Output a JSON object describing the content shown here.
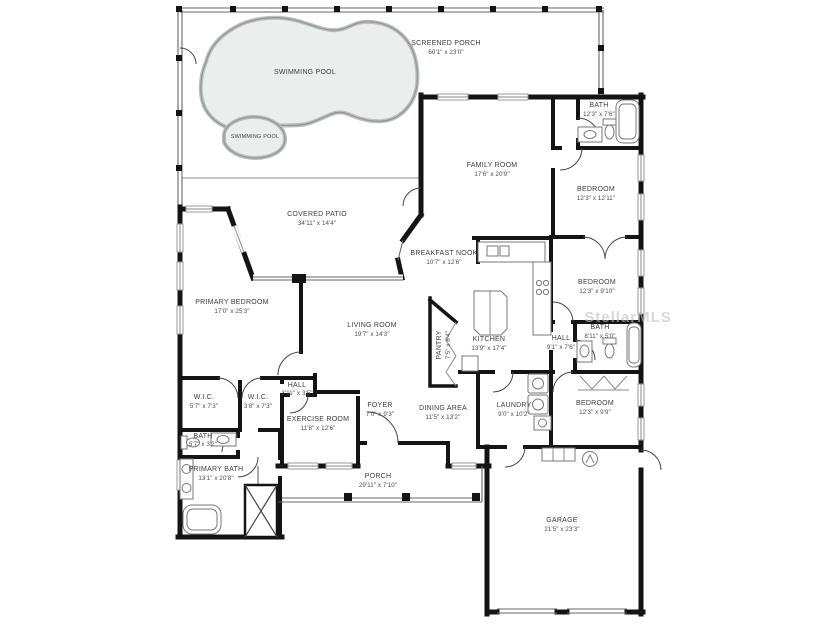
{
  "watermark": "StellarMLS",
  "colors": {
    "wall": "#141414",
    "label_text": "#3c3c3c",
    "pool_fill": "#eceeee",
    "pool_stroke": "#8f9696",
    "watermark": "#bcbfbf"
  },
  "rooms": [
    {
      "name": "SWIMMING POOL",
      "dims": ""
    },
    {
      "name": "SWIMMING POOL",
      "dims": ""
    },
    {
      "name": "SCREENED PORCH",
      "dims": "60'1\" x 23'0\""
    },
    {
      "name": "FAMILY ROOM",
      "dims": "17'6\" x 20'9\""
    },
    {
      "name": "BATH",
      "dims": "12'3\" x 7'6\""
    },
    {
      "name": "BEDROOM",
      "dims": "12'3\" x 12'11\""
    },
    {
      "name": "COVERED PATIO",
      "dims": "34'11\" x 14'4\""
    },
    {
      "name": "BREAKFAST NOOK",
      "dims": "10'7\" x 12'6\""
    },
    {
      "name": "BEDROOM",
      "dims": "12'3\" x 9'10\""
    },
    {
      "name": "KITCHEN",
      "dims": "13'9\" x 17'4\""
    },
    {
      "name": "PANTRY",
      "dims": "7'5\" x 8'4\""
    },
    {
      "name": "PRIMARY BEDROOM",
      "dims": "17'0\" x 25'3\""
    },
    {
      "name": "LIVING ROOM",
      "dims": "19'7\" x 14'3\""
    },
    {
      "name": "BATH",
      "dims": "8'11\" x 5'0\""
    },
    {
      "name": "HALL",
      "dims": "9'1\" x 7'6\""
    },
    {
      "name": "W.I.C.",
      "dims": "5'7\" x 7'3\""
    },
    {
      "name": "W.I.C.",
      "dims": "3'8\" x 7'3\""
    },
    {
      "name": "HALL",
      "dims": "3'11\" x 3'5\""
    },
    {
      "name": "EXERCISE ROOM",
      "dims": "11'8\" x 12'6\""
    },
    {
      "name": "BATH",
      "dims": "5'7\" x 3'2\""
    },
    {
      "name": "PRIMARY BATH",
      "dims": "13'1\" x 20'8\""
    },
    {
      "name": "FOYER",
      "dims": "7'0\" x 9'3\""
    },
    {
      "name": "DINING AREA",
      "dims": "11'5\" x 13'2\""
    },
    {
      "name": "LAUNDRY",
      "dims": "9'0\" x 10'2\""
    },
    {
      "name": "BEDROOM",
      "dims": "12'3\" x 9'9\""
    },
    {
      "name": "PORCH",
      "dims": "29'11\" x 7'10\""
    },
    {
      "name": "GARAGE",
      "dims": "21'5\" x 23'3\""
    }
  ]
}
